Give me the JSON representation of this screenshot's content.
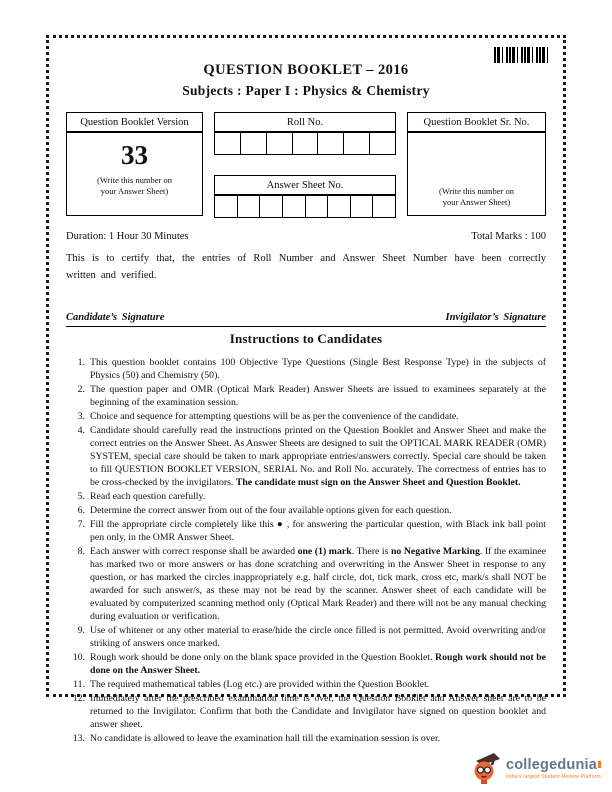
{
  "page": {
    "title": "QUESTION BOOKLET – 2016",
    "subtitle": "Subjects : Paper I : Physics & Chemistry"
  },
  "version_box": {
    "header": "Question Booklet Version",
    "number": "33",
    "note_line1": "(Write this number on",
    "note_line2": "your Answer Sheet)"
  },
  "roll_no": {
    "label": "Roll No.",
    "cells": 7
  },
  "answer_sheet_no": {
    "label": "Answer Sheet No.",
    "cells": 8
  },
  "sr_no_box": {
    "header": "Question Booklet Sr. No.",
    "note_line1": "(Write this number on",
    "note_line2": "your Answer Sheet)"
  },
  "meta": {
    "duration": "Duration: 1 Hour 30 Minutes",
    "total_marks": "Total Marks : 100",
    "certify": "This is to certify that, the entries of Roll Number and Answer Sheet Number have been correctly written and verified.",
    "candidate_signature": "Candidate’s Signature",
    "invigilator_signature": "Invigilator’s Signature"
  },
  "instructions": {
    "title": "Instructions to Candidates",
    "items": [
      [
        {
          "t": "This question booklet contains 100 Objective Type Questions (Single Best Response Type) in the subjects of Physics (50) and Chemistry (50).",
          "b": false
        }
      ],
      [
        {
          "t": "The question paper and OMR (Optical Mark Reader) Answer Sheets are issued to examinees separately at the beginning of the examination session.",
          "b": false
        }
      ],
      [
        {
          "t": "Choice and sequence for attempting questions will be as per the convenience of the candidate.",
          "b": false
        }
      ],
      [
        {
          "t": "Candidate should carefully read the instructions printed on the Question Booklet and Answer Sheet and make the correct entries on the Answer Sheet. As Answer Sheets are designed to suit the OPTICAL MARK READER (OMR) SYSTEM, special care should be taken to mark appropriate entries/answers correctly. Special care should be taken to fill QUESTION BOOKLET VERSION, SERIAL No. and Roll No. accurately. The correctness of entries has to be cross-checked by the invigilators. ",
          "b": false
        },
        {
          "t": "The candidate must sign on the Answer Sheet and Question Booklet.",
          "b": true
        }
      ],
      [
        {
          "t": "Read each question carefully.",
          "b": false
        }
      ],
      [
        {
          "t": "Determine the correct answer from out of the four available options given for each question.",
          "b": false
        }
      ],
      [
        {
          "t": "Fill the appropriate circle completely like this ● , for answering the particular question, with Black ink ball point pen only, in the OMR Answer Sheet.",
          "b": false
        }
      ],
      [
        {
          "t": "Each answer with correct response shall be awarded ",
          "b": false
        },
        {
          "t": "one (1) mark",
          "b": true
        },
        {
          "t": ". There is ",
          "b": false
        },
        {
          "t": "no Negative Marking",
          "b": true
        },
        {
          "t": ". If the examinee has marked two or more answers or has done scratching and overwriting in the Answer Sheet in response to any question, or has marked the circles inappropriately e.g. half circle, dot, tick mark, cross etc, mark/s shall NOT be awarded for such answer/s, as these may not be read by the scanner. Answer sheet of each candidate will be evaluated by computerized scanning method only (Optical Mark Reader) and there will not be any manual checking during evaluation or verification.",
          "b": false
        }
      ],
      [
        {
          "t": "Use of whitener or any other material to erase/hide the circle once filled is not permitted. Avoid overwriting and/or striking of answers once marked.",
          "b": false
        }
      ],
      [
        {
          "t": "Rough work should be done only on the blank space provided in the Question Booklet. ",
          "b": false
        },
        {
          "t": "Rough work should not be done on the Answer Sheet.",
          "b": true
        }
      ],
      [
        {
          "t": "The required mathematical tables (Log etc.) are provided within the Question Booklet.",
          "b": false
        }
      ],
      [
        {
          "t": "Immediately after the prescribed examination time is over, the Question Booklet and Answer sheet are to be returned to the Invigilator. Confirm that both the Candidate and Invigilator have signed on question booklet and answer sheet.",
          "b": false
        }
      ],
      [
        {
          "t": "No candidate is allowed to leave the examination hall till the examination session is over.",
          "b": false
        }
      ]
    ]
  },
  "logo": {
    "name": "collegedunia",
    "tagline": "India's largest Student Review Platform",
    "brand_color": "#5d7a8e",
    "accent_color": "#f47b20"
  }
}
